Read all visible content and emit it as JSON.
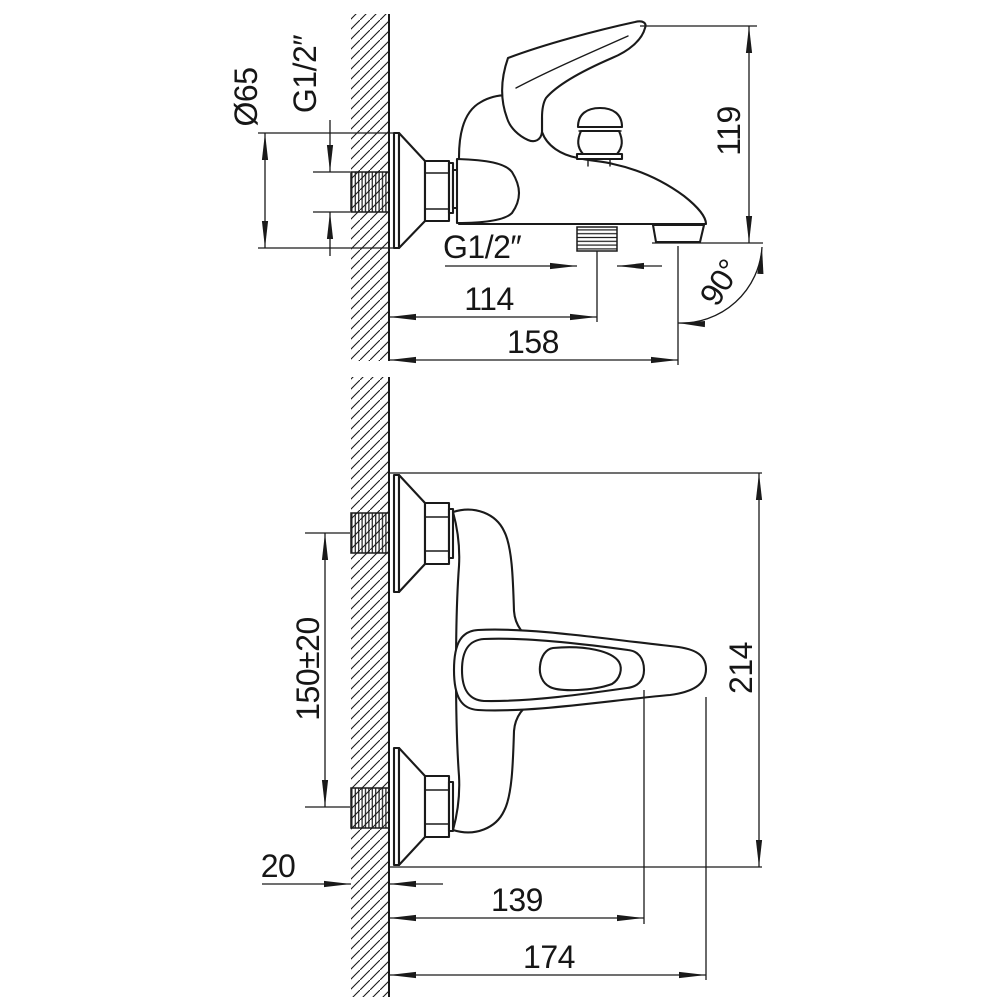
{
  "drawing": {
    "background_color": "#ffffff",
    "line_color": "#1a1a1a",
    "side_view": {
      "dims": {
        "escutcheon_diameter": "Ø65",
        "inlet_thread": "G1/2″",
        "height": "119",
        "outlet_thread": "G1/2″",
        "outlet_offset": "114",
        "spout_reach": "158",
        "outlet_angle": "90°"
      }
    },
    "plan_view": {
      "dims": {
        "pipe_spacing": "150±20",
        "overall_span": "214",
        "wall_thickness": "20",
        "body_reach": "139",
        "handle_reach": "174"
      }
    }
  }
}
